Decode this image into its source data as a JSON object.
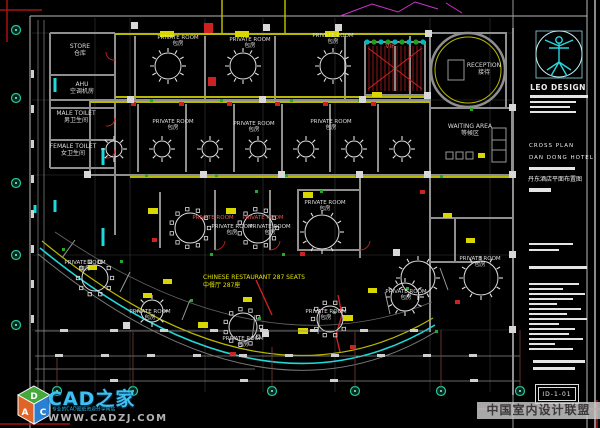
{
  "colors": {
    "bg": "#000000",
    "wall_gray": "#8f8f8f",
    "wall_yellow": "#b8b800",
    "accent_yellow": "#e3e300",
    "accent_red": "#cc2222",
    "accent_green": "#27a827",
    "accent_cyan": "#20d8d8",
    "accent_magenta": "#cc33cc",
    "line_white": "#e0e0e0",
    "logo_cyan": "#3ec0f0",
    "watermark_bar": "#cdcdcd"
  },
  "rooms": {
    "store": {
      "en": "STORE",
      "cn": "仓库"
    },
    "ahu": {
      "en": "AHU",
      "cn": "空调机房"
    },
    "male_toilet": {
      "en": "MALE TOILET",
      "cn": "男卫生间"
    },
    "female_toilet": {
      "en": "FEMALE TOILET",
      "cn": "女卫生间"
    },
    "private_room": {
      "en": "PRIVATE ROOM",
      "cn": "包房"
    },
    "reception": {
      "en": "RECEPTION",
      "cn": "接待"
    },
    "waiting_area": {
      "en": "WAITING AREA",
      "cn": "等候区"
    },
    "vip": {
      "en": "VIP"
    },
    "restaurant": {
      "en": "CHINESE RESTAURANT 287 SEATS",
      "cn": "中餐厅 287座"
    }
  },
  "titleblock": {
    "firm_name": "LEO DESIGN",
    "drawing_title_en1": "CROSS PLAN",
    "drawing_title_en2": "DAN DONG HOTEL",
    "drawing_title_cn": "丹东酒店平面布置图",
    "sheet_number": "ID-1-01"
  },
  "watermarks": {
    "site_name": "CAD之家",
    "site_url": "WWW.CADZJ.COM",
    "site_tagline": "专业的CAD图纸资源分享网站",
    "cube_letter_top": "D",
    "cube_letter_left": "A",
    "cube_letter_right": "C",
    "alliance_name": "中国室内设计联盟"
  }
}
